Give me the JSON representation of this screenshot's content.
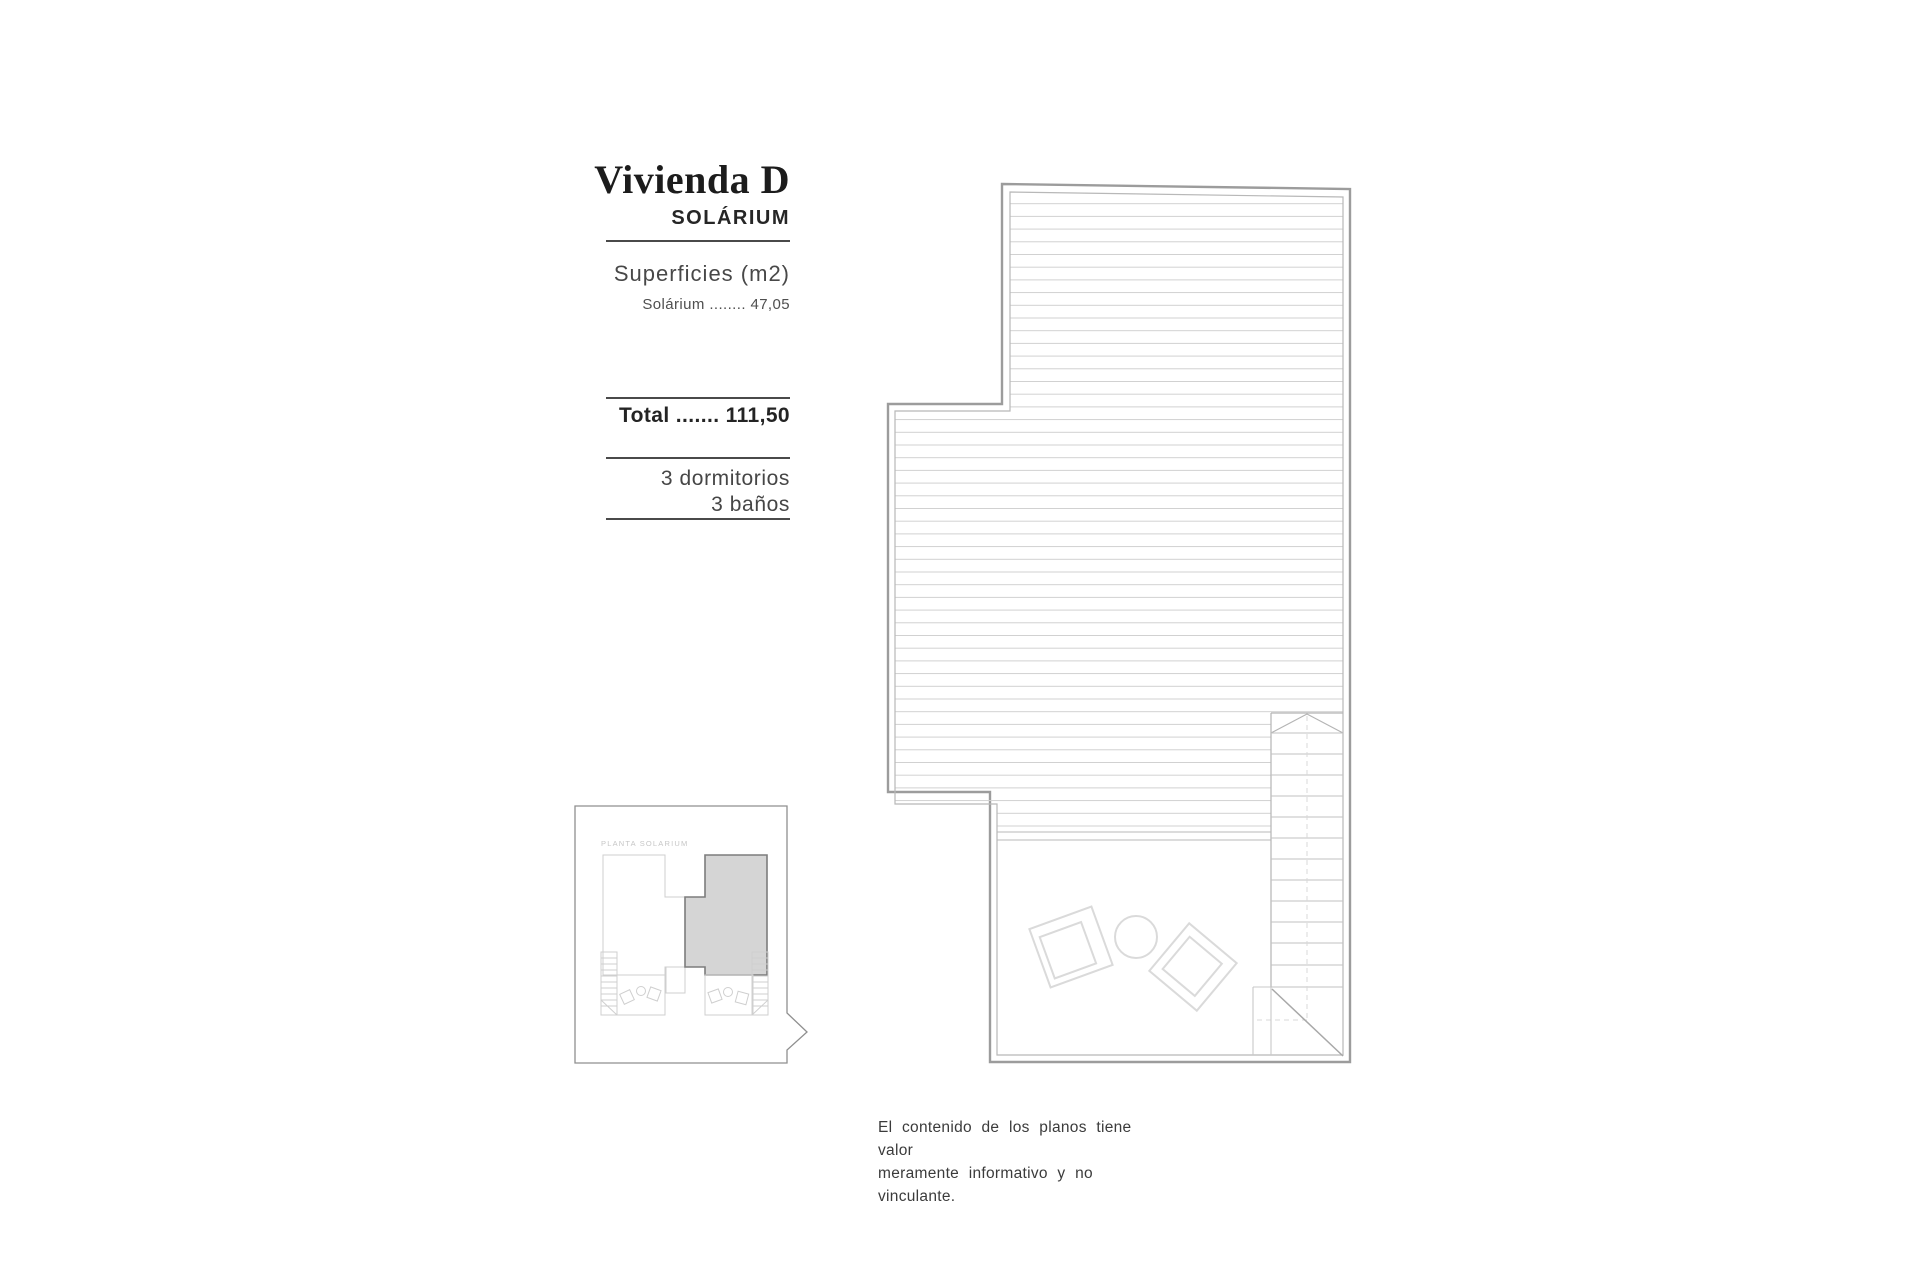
{
  "info_panel": {
    "title": "Vivienda D",
    "subtitle": "SOLÁRIUM",
    "surfaces_header": "Superficies (m2)",
    "surface_line": "Solárium ........ 47,05",
    "total_line": "Total ....... 111,50",
    "bedrooms": "3 dormitorios",
    "bathrooms": "3 baños"
  },
  "key_plan": {
    "label": "PLANTA SOLARIUM",
    "highlight_color": "#d5d5d5"
  },
  "disclaimer": {
    "line1": "El contenido de los planos tiene valor",
    "line2": "meramente informativo y no vinculante."
  }
}
